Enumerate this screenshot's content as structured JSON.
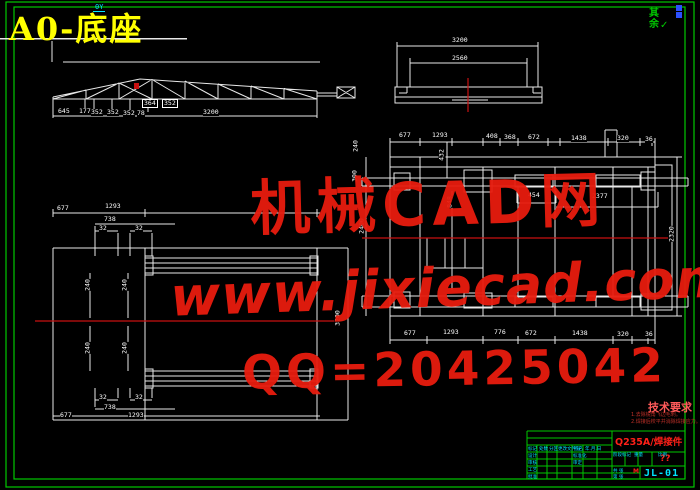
{
  "window": {
    "title": "A0-底座"
  },
  "corner": {
    "ucs_label": "0Y",
    "roughness_text": "其余",
    "roughness_mark": "✓"
  },
  "watermark": {
    "brand": "机械CAD网",
    "url": "www.jixiecad.com",
    "qq": "QQ=20425042"
  },
  "tech_notes": {
    "title": "技术要求",
    "items": [
      "1.去除锐角飞边毛刺。",
      "2.焊接后校平并消除焊接应力。"
    ]
  },
  "title_block": {
    "material": "Q235A/焊接件",
    "scale_value": "??",
    "drawing_no": "JL-01",
    "mass_mark": "M",
    "tiny_labels": [
      {
        "t": "标记",
        "x": 528,
        "y": 447
      },
      {
        "t": "处数",
        "x": 539,
        "y": 447
      },
      {
        "t": "分区",
        "x": 549,
        "y": 447
      },
      {
        "t": "更改文件号",
        "x": 558,
        "y": 447
      },
      {
        "t": "签名",
        "x": 574,
        "y": 447
      },
      {
        "t": "年.月.日",
        "x": 585,
        "y": 447
      },
      {
        "t": "设计",
        "x": 528,
        "y": 454
      },
      {
        "t": "审核",
        "x": 528,
        "y": 461
      },
      {
        "t": "工艺",
        "x": 528,
        "y": 468
      },
      {
        "t": "批准",
        "x": 528,
        "y": 475
      },
      {
        "t": "标准化",
        "x": 573,
        "y": 454
      },
      {
        "t": "审定",
        "x": 573,
        "y": 461
      },
      {
        "t": "阶段标记",
        "x": 613,
        "y": 453
      },
      {
        "t": "重量",
        "x": 634,
        "y": 453
      },
      {
        "t": "比例",
        "x": 658,
        "y": 453
      },
      {
        "t": "共 张",
        "x": 613,
        "y": 469
      },
      {
        "t": "第 张",
        "x": 613,
        "y": 475
      }
    ]
  },
  "dim_labels": [
    {
      "t": "645",
      "x": 58,
      "y": 108
    },
    {
      "t": "177",
      "x": 79,
      "y": 108
    },
    {
      "t": "352",
      "x": 91,
      "y": 109
    },
    {
      "t": "352",
      "x": 107,
      "y": 109
    },
    {
      "t": "352",
      "x": 123,
      "y": 110
    },
    {
      "t": "78",
      "x": 137,
      "y": 110
    },
    {
      "t": "364",
      "x": 142,
      "y": 99,
      "boxed": true
    },
    {
      "t": "352",
      "x": 162,
      "y": 99,
      "boxed": true
    },
    {
      "t": "3200",
      "x": 203,
      "y": 109
    },
    {
      "t": "3200",
      "x": 452,
      "y": 37
    },
    {
      "t": "2560",
      "x": 452,
      "y": 55
    },
    {
      "t": "677",
      "x": 399,
      "y": 132
    },
    {
      "t": "1293",
      "x": 432,
      "y": 132
    },
    {
      "t": "408",
      "x": 486,
      "y": 133
    },
    {
      "t": "368",
      "x": 504,
      "y": 134
    },
    {
      "t": "672",
      "x": 528,
      "y": 134
    },
    {
      "t": "1438",
      "x": 571,
      "y": 135
    },
    {
      "t": "320",
      "x": 617,
      "y": 135
    },
    {
      "t": "36",
      "x": 645,
      "y": 136
    },
    {
      "t": "677",
      "x": 404,
      "y": 330
    },
    {
      "t": "1293",
      "x": 443,
      "y": 329
    },
    {
      "t": "776",
      "x": 494,
      "y": 329
    },
    {
      "t": "672",
      "x": 525,
      "y": 330
    },
    {
      "t": "1438",
      "x": 572,
      "y": 330
    },
    {
      "t": "320",
      "x": 617,
      "y": 331
    },
    {
      "t": "36",
      "x": 645,
      "y": 331
    },
    {
      "t": "240",
      "x": 356,
      "y": 146,
      "r": true
    },
    {
      "t": "300",
      "x": 355,
      "y": 176,
      "r": true
    },
    {
      "t": "2400",
      "x": 362,
      "y": 226,
      "r": true
    },
    {
      "t": "3200",
      "x": 338,
      "y": 318,
      "r": true
    },
    {
      "t": "432",
      "x": 442,
      "y": 155,
      "r": true
    },
    {
      "t": "848",
      "x": 450,
      "y": 202,
      "r": true
    },
    {
      "t": "454",
      "x": 528,
      "y": 192
    },
    {
      "t": "2377",
      "x": 592,
      "y": 193
    },
    {
      "t": "2320",
      "x": 672,
      "y": 234,
      "r": true
    },
    {
      "t": "677",
      "x": 57,
      "y": 205
    },
    {
      "t": "1293",
      "x": 105,
      "y": 203
    },
    {
      "t": "738",
      "x": 104,
      "y": 216
    },
    {
      "t": "32",
      "x": 99,
      "y": 225
    },
    {
      "t": "32",
      "x": 135,
      "y": 225
    },
    {
      "t": "240",
      "x": 88,
      "y": 285,
      "r": true
    },
    {
      "t": "240",
      "x": 125,
      "y": 285,
      "r": true
    },
    {
      "t": "240",
      "x": 88,
      "y": 348,
      "r": true
    },
    {
      "t": "240",
      "x": 125,
      "y": 348,
      "r": true
    },
    {
      "t": "32",
      "x": 99,
      "y": 394
    },
    {
      "t": "32",
      "x": 135,
      "y": 394
    },
    {
      "t": "738",
      "x": 104,
      "y": 404
    },
    {
      "t": "1293",
      "x": 128,
      "y": 412
    },
    {
      "t": "677",
      "x": 60,
      "y": 412
    }
  ]
}
